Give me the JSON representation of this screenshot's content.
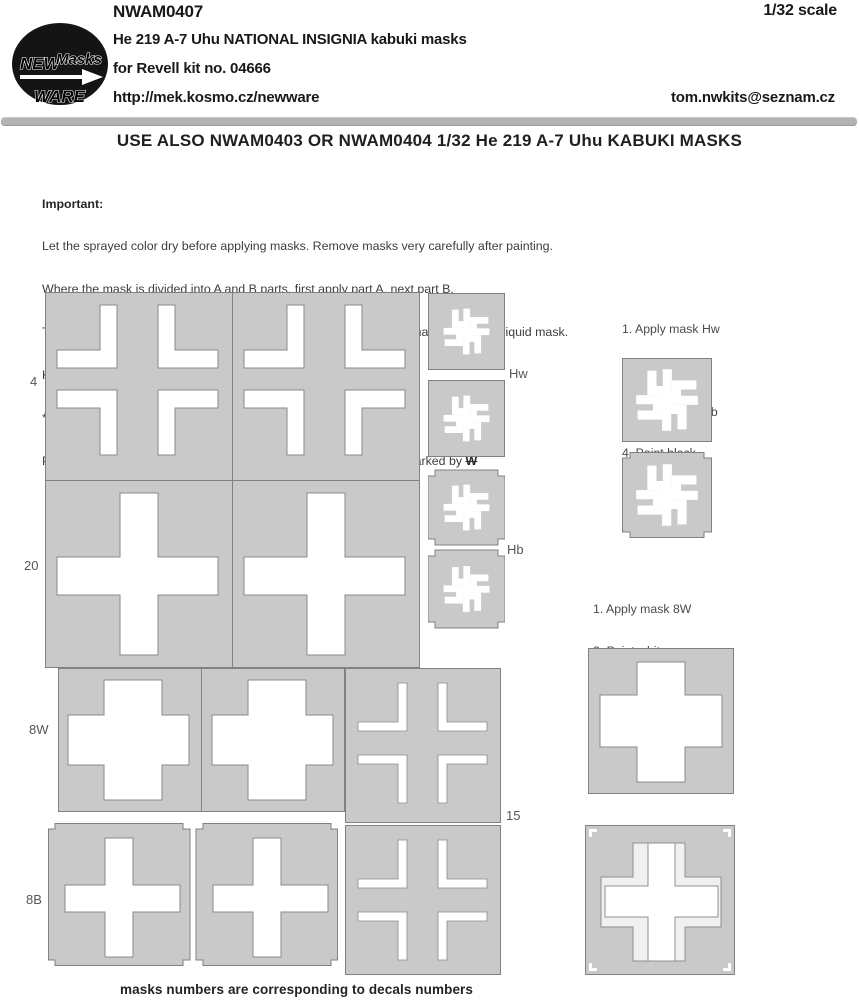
{
  "header": {
    "product_code": "NWAM0407",
    "scale": "1/32 scale",
    "title_line1": "He 219 A-7 Uhu NATIONAL INSIGNIA kabuki masks",
    "title_line2": "for Revell kit no. 04666",
    "website": "http://mek.kosmo.cz/newware",
    "email": "tom.nwkits@seznam.cz",
    "logo": {
      "word1": "NEW",
      "word2": "Masks",
      "word3": "WARE"
    }
  },
  "banner": {
    "text": "USE ALSO NWAM0403 OR NWAM0404 1/32 He 219 A-7 Uhu KABUKI MASKS"
  },
  "important": {
    "heading": "Important:",
    "lines": [
      "Let the sprayed color dry before applying masks. Remove masks very carefully after painting.",
      "Where the mask is divided into A and B parts, first apply part A, next part B.",
      "The set does not include masks for all areas, so mask the rest with masking tape or liquid mask.",
      "K kit part",
      "*  start placing the mask from this point",
      "Placing wet masks on wet surface is recommended, except those marked by "
    ],
    "marked_symbol": "W"
  },
  "instructions_tail": {
    "items": [
      "1. Apply mask Hw",
      "2. Paint white",
      "3. Apply mask Hb",
      "4. Paint black"
    ]
  },
  "instructions_cross": {
    "items": [
      "1. Apply mask 8W",
      "2. Paint white",
      "3. Apply mask 8B",
      "4. Paint black"
    ]
  },
  "mask_labels": {
    "corner_panel": "4",
    "cross_panel": "20",
    "row_white": "8W",
    "row_black": "8B",
    "trim_panel": "15",
    "tail_white": "Hw",
    "tail_black": "Hb"
  },
  "footer": {
    "note": "masks numbers are corresponding to decals numbers"
  },
  "colors": {
    "mask_fill": "#c9c9c9",
    "mask_outline": "#818181",
    "cutout": "#ffffff",
    "divider_bar": "#b3b3b3",
    "text_primary": "#1a1a1a",
    "text_secondary": "#4a4a4a"
  }
}
